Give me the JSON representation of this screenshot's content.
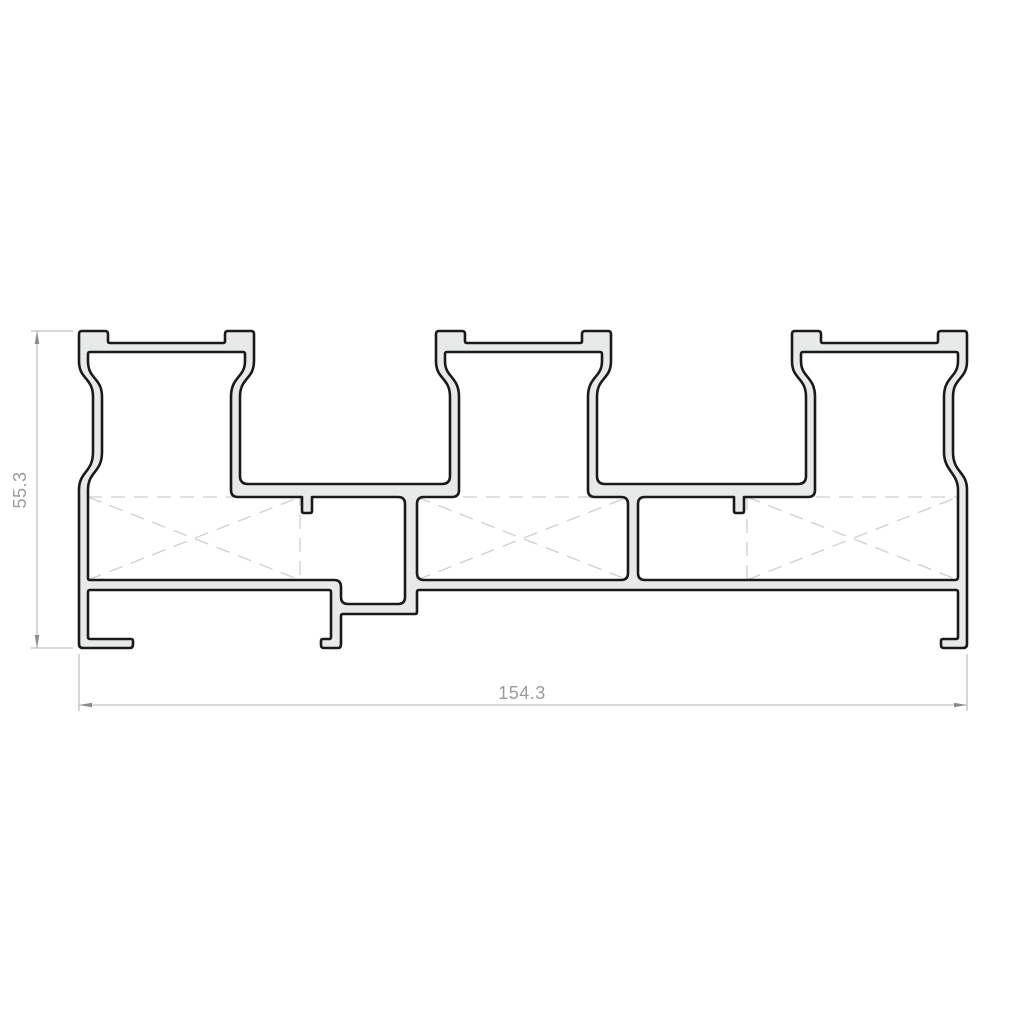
{
  "page": {
    "background": "#ffffff",
    "kind": "technical-drawing"
  },
  "drawing": {
    "type": "extrusion-profile-cross-section",
    "description": "Cross-section of a three-chamber extruded profile with three T-shaped towers, dashed hollow-chamber markers, stepped base and mounting feet",
    "chamber_count": 3,
    "tower_count": 3,
    "colors": {
      "material_fill": "#e8e9e9",
      "outline": "#1a1a1a",
      "chamber_dash": "#cfcfcf",
      "dimension_line": "#b5b5b5",
      "dimension_arrow": "#8c8c8c",
      "dimension_text": "#9c9c9c",
      "background": "#ffffff"
    },
    "dimensions": {
      "height": {
        "value": "55.3",
        "orientation": "vertical",
        "position": "left"
      },
      "width": {
        "value": "154.3",
        "orientation": "horizontal",
        "position": "bottom"
      }
    }
  }
}
